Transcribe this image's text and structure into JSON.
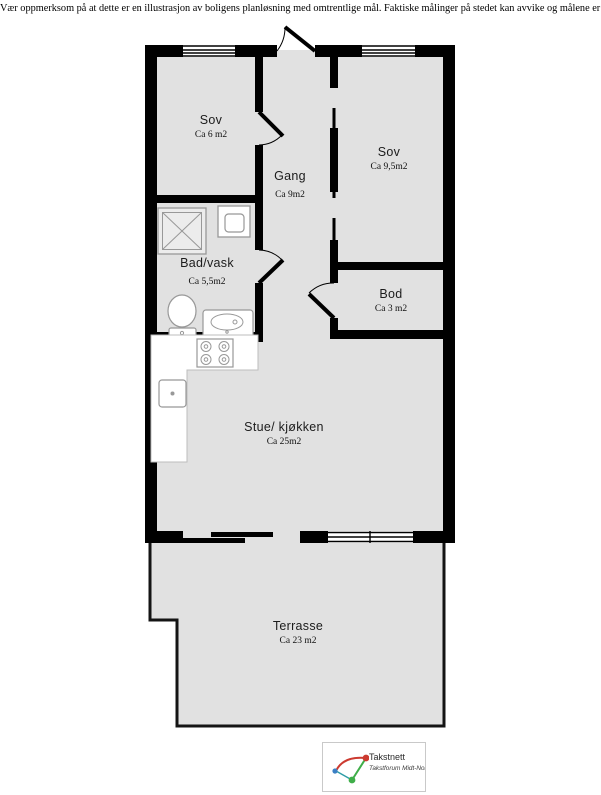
{
  "disclaimer": "Vær oppmerksom på at dette er en illustrasjon av boligens planløsning med omtrentlige mål. Faktiske målinger på stedet kan avvike og målene er ikke juridisk bindende.",
  "rooms": [
    {
      "id": "sov-1",
      "name": "Sov",
      "area": "Ca 6 m2"
    },
    {
      "id": "gang",
      "name": "Gang",
      "area": "Ca 9m2"
    },
    {
      "id": "sov-2",
      "name": "Sov",
      "area": "Ca 9,5m2"
    },
    {
      "id": "bad-vask",
      "name": "Bad/vask",
      "area": "Ca 5,5m2"
    },
    {
      "id": "bod",
      "name": "Bod",
      "area": "Ca 3 m2"
    },
    {
      "id": "stue-kjokken",
      "name": "Stue/ kjøkken",
      "area": "Ca 25m2"
    },
    {
      "id": "terrasse",
      "name": "Terrasse",
      "area": "Ca 23 m2"
    }
  ],
  "logo": {
    "title": "Takstnett",
    "subtitle": "Takstforum Midt-Norge"
  },
  "colors": {
    "wall": "#000000",
    "floor": "#e1e1e1",
    "fixture_stroke": "#999999",
    "logo_red": "#cc3a30",
    "logo_green": "#3fae49",
    "logo_blue": "#3b7fc4"
  },
  "icons": [
    "shower-icon",
    "washing-machine-icon",
    "toilet-icon",
    "bathroom-sink-icon",
    "stove-icon",
    "kitchen-sink-icon",
    "door-swing-icon",
    "window-icon",
    "sliding-door-icon"
  ]
}
